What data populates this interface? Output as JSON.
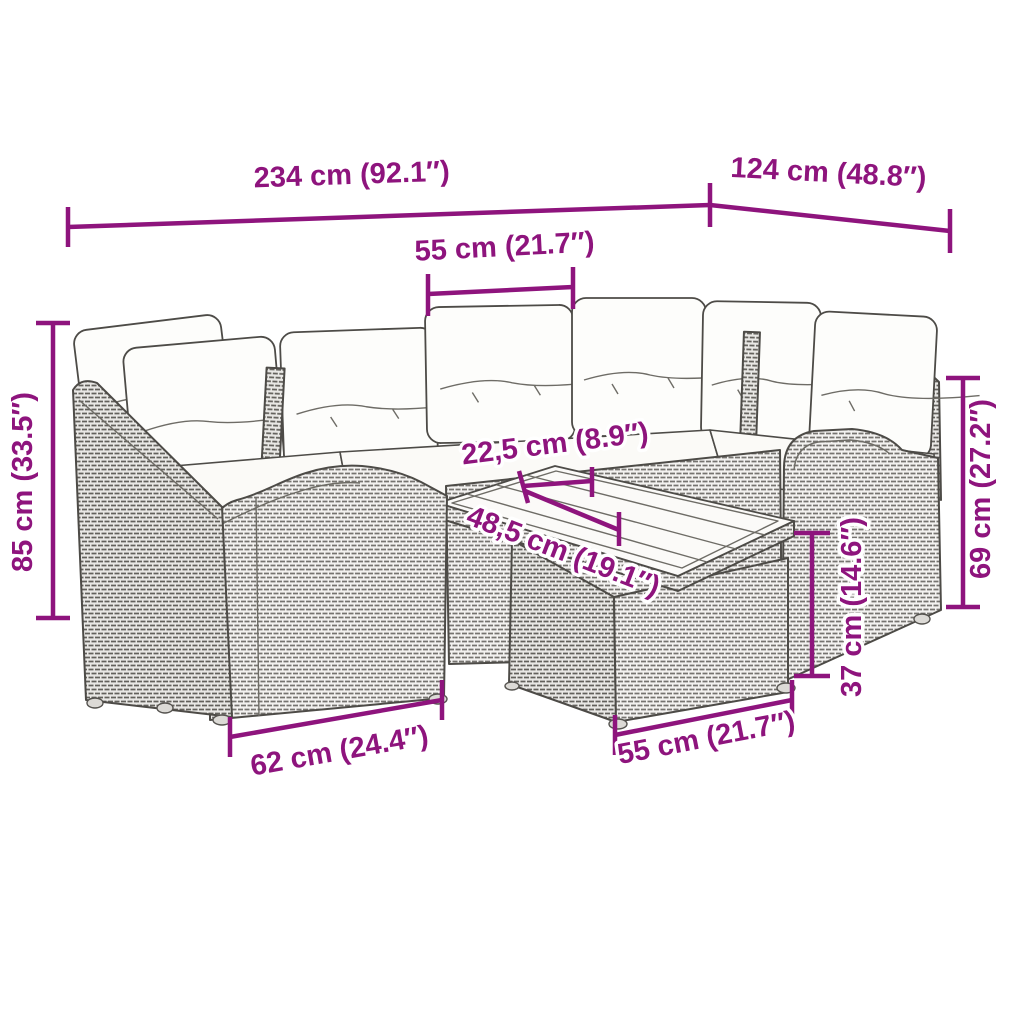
{
  "diagram": {
    "accent_color": "#8E147D",
    "illustration": "rattan-corner-sofa-set-with-cushions-and-coffee-table",
    "labels": {
      "total_width": "234 cm (92.1″)",
      "total_depth": "124 cm (48.8″)",
      "seat_width_top": "55 cm (21.7″)",
      "total_height": "85 cm (33.5″)",
      "backrest_height": "69 cm (27.2″)",
      "table_height": "37 cm (14.6″)",
      "table_gap": "22,5 cm (8.9″)",
      "table_length": "48,5 cm (19.1″)",
      "module_width": "62 cm (24.4″)",
      "table_width_bottom": "55 cm (21.7″)"
    }
  }
}
